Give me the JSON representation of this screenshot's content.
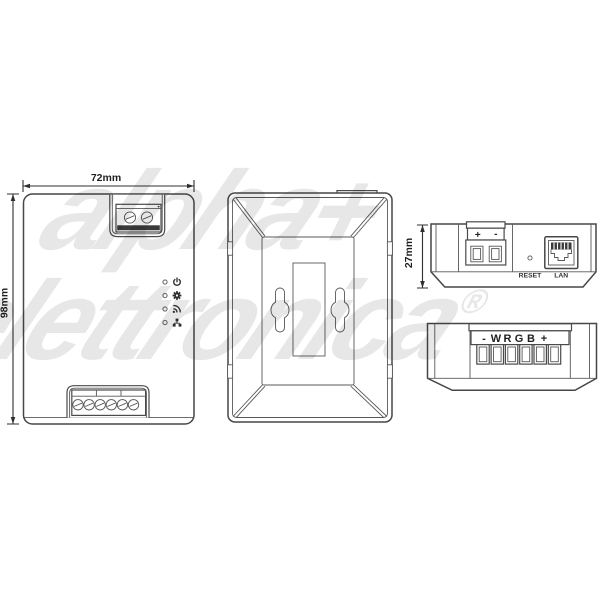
{
  "watermark": {
    "line1": "alpha+",
    "line2": "elettronica",
    "registered": "®"
  },
  "dimensions": {
    "width": "72mm",
    "height": "98mm",
    "depth": "27mm"
  },
  "front_view": {
    "led_icons": [
      "power",
      "settings",
      "wifi",
      "network"
    ]
  },
  "top_side_view": {
    "plus": "+",
    "minus": "-",
    "reset_label": "RESET",
    "lan_label": "LAN"
  },
  "bottom_side_view": {
    "terminal_labels": [
      "-",
      "W",
      "R",
      "G",
      "B",
      "+"
    ]
  }
}
